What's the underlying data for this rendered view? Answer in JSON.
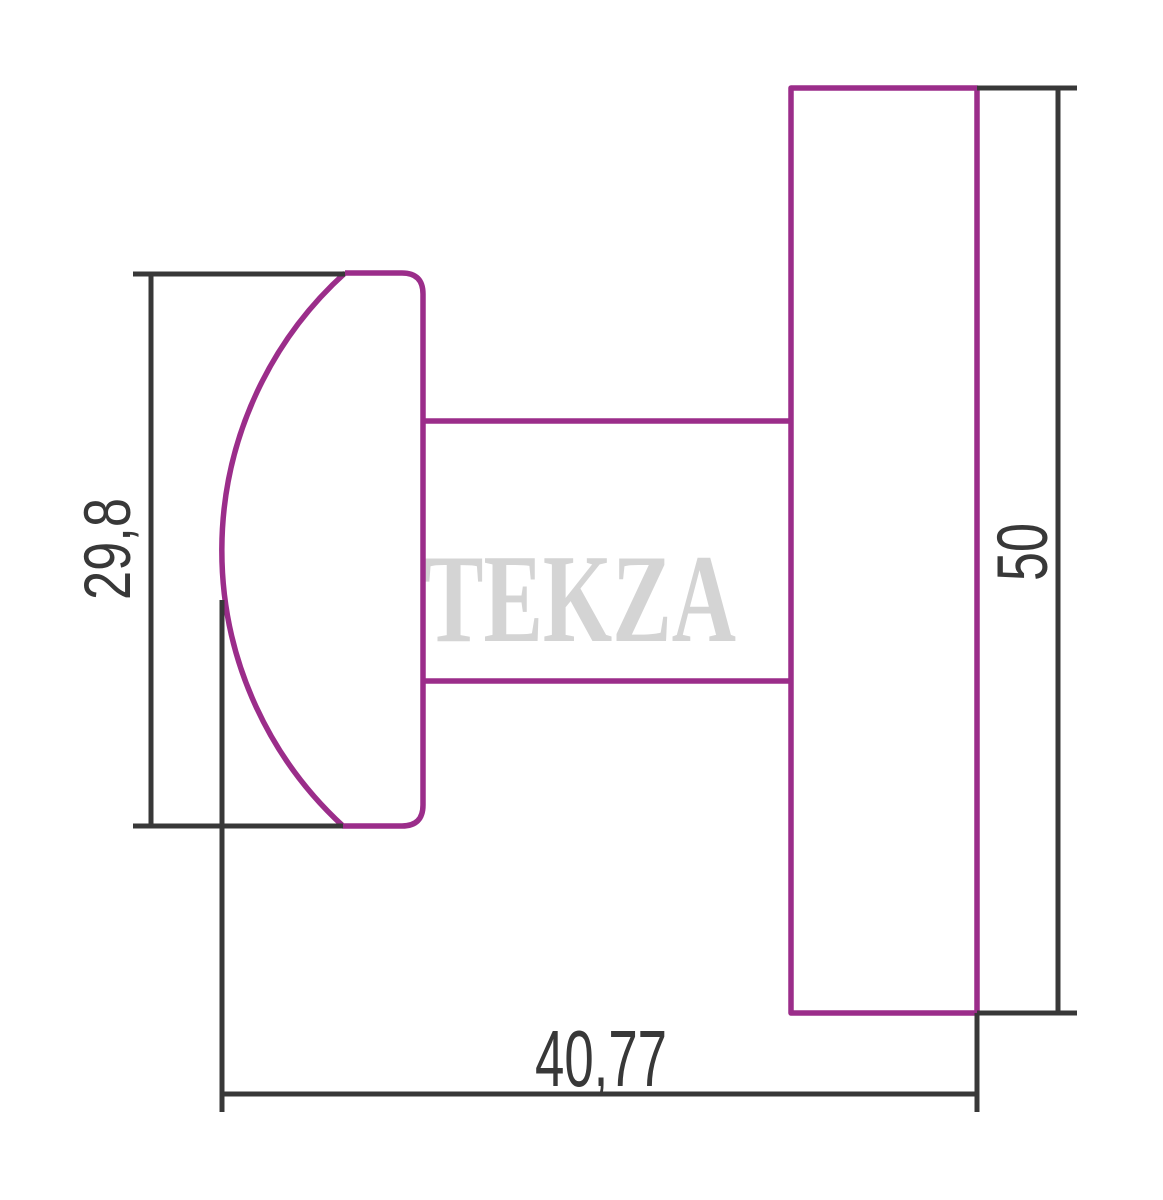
{
  "watermark": {
    "text": "TEKZA",
    "color": "#d4d4d4"
  },
  "colors": {
    "outline": "#9b2d8a",
    "dimension_lines": "#383838",
    "background": "#ffffff"
  },
  "dimensions": {
    "knob_height": {
      "label": "29,8",
      "orientation": "vertical"
    },
    "plate_height": {
      "label": "50",
      "orientation": "vertical"
    },
    "depth": {
      "label": "40,77",
      "orientation": "horizontal"
    }
  }
}
